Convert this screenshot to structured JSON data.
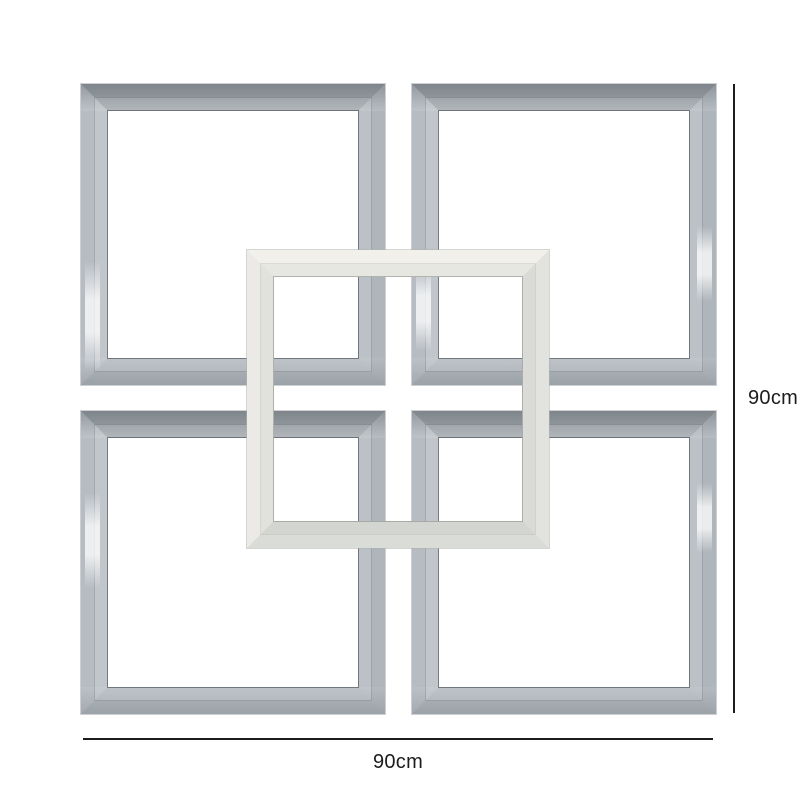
{
  "annotations": {
    "height_label": "90cm",
    "width_label": "90cm"
  },
  "scene": {
    "frames": [
      {
        "id": "mirror-frame-top-left"
      },
      {
        "id": "mirror-frame-top-right"
      },
      {
        "id": "mirror-frame-bottom-left"
      },
      {
        "id": "mirror-frame-bottom-right"
      },
      {
        "id": "mirror-frame-center"
      }
    ]
  },
  "colors": {
    "background": "#ffffff",
    "dimension_line": "#1c1c1c",
    "label_text": "#1c1c1c",
    "mirror_top": "#99a0a5",
    "mirror_right": "#aeb5bb",
    "mirror_bottom": "#acb3b9",
    "mirror_left": "#b6bcc2",
    "mirror_inner_edge": "rgba(72,78,84,0.6)",
    "mirror_outer_edge": "rgba(130,136,142,0.4)",
    "center_top": "#f1f0eb",
    "center_right": "#e2e3df",
    "center_bottom": "#dadcd7",
    "center_left": "#ebeae6",
    "center_inner_edge": "rgba(125,128,124,0.55)"
  }
}
